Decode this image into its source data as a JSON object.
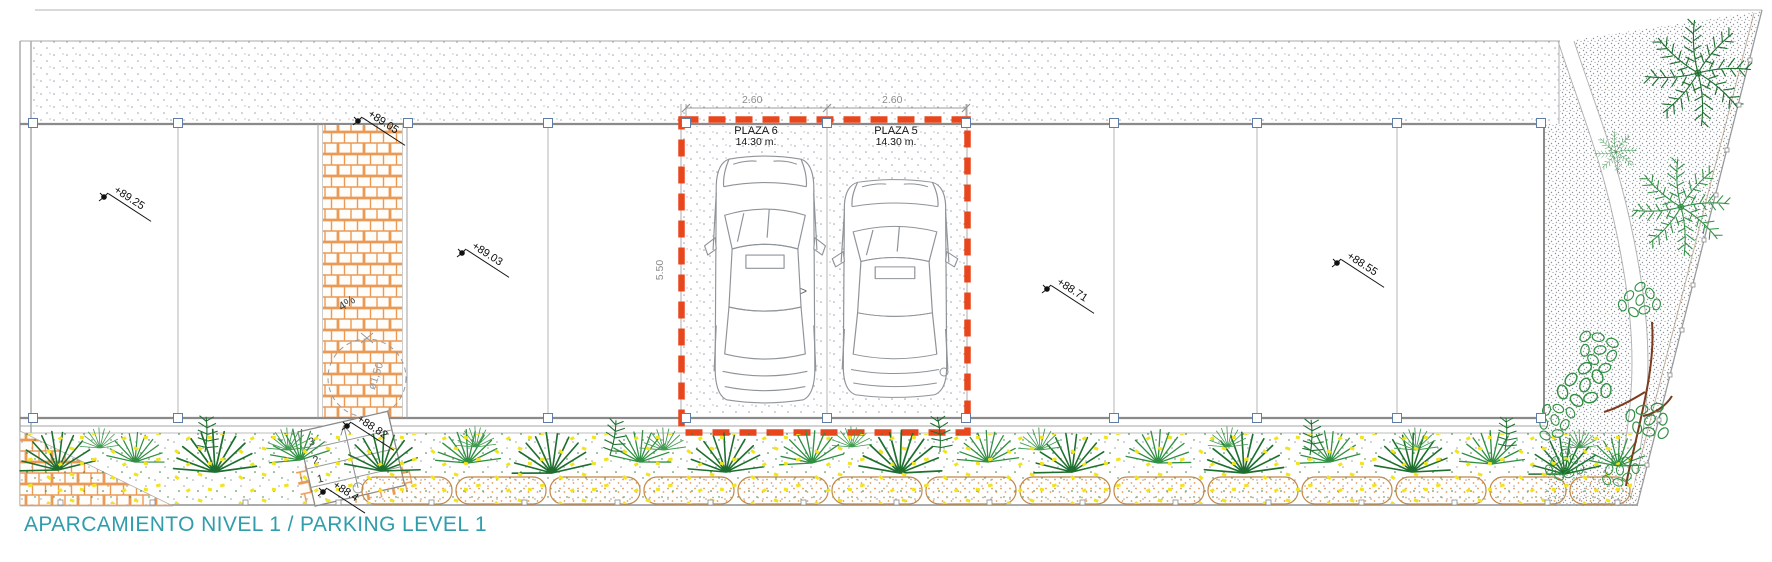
{
  "title": "APARCAMIENTO NIVEL 1 / PARKING LEVEL 1",
  "plazas": [
    {
      "name": "PLAZA 6",
      "area": "14.30 m.",
      "width_dim": "2.60"
    },
    {
      "name": "PLAZA 5",
      "area": "14.30 m.",
      "width_dim": "2.60"
    }
  ],
  "dimensions": {
    "bay_depth": "5.50",
    "turning_circle": "ø1,50",
    "ramp_slope": "4%"
  },
  "markers": [
    {
      "label": "+89.25"
    },
    {
      "label": "+89.05"
    },
    {
      "label": "+89.03"
    },
    {
      "label": "+88.82"
    },
    {
      "label": "+88.4"
    },
    {
      "label": "+88.71"
    },
    {
      "label": "+88.55"
    }
  ],
  "stairs": {
    "steps": [
      "3",
      "2",
      "1"
    ]
  },
  "direction_arrow": ">",
  "colors": {
    "highlight_red": "#e8471d",
    "brick_orange": "#eb9a55",
    "title_teal": "#2f9dab",
    "plant_green": "#2f8f42",
    "flower_yellow": "#f1e41c",
    "line_gray": "#8c8c8c"
  }
}
